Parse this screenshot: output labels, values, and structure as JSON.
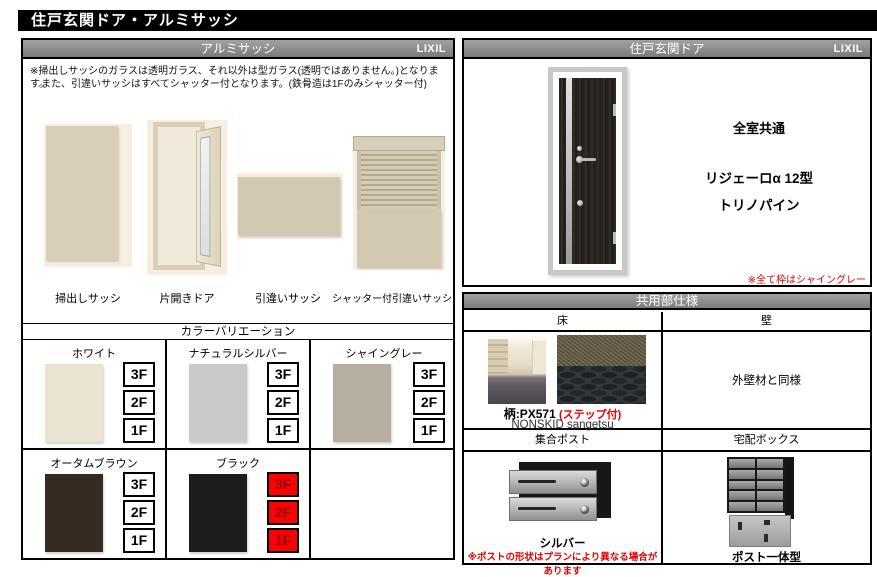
{
  "page": {
    "title": "住戸玄関ドア・アルミサッシ"
  },
  "colors": {
    "header_gray": "#8a8a8a",
    "highlight_red": "#ff0000",
    "note_red": "#e60000"
  },
  "sash": {
    "title": "アルミサッシ",
    "brand": "LIXIL",
    "note1": "※掃出しサッシのガラスは透明ガラス、それ以外は型ガラス(透明ではありません。)となります。",
    "note2": "また、引違いサッシはすべてシャッター付となります。(鉄骨造は1Fのみシャッター付)",
    "products": [
      {
        "label": "掃出しサッシ"
      },
      {
        "label": "片開きドア"
      },
      {
        "label": "引違いサッシ"
      },
      {
        "label": "シャッター付引違いサッシ"
      }
    ],
    "color_title": "カラーバリエーション",
    "floors": [
      "3F",
      "2F",
      "1F"
    ],
    "highlight_color": "#ff0000",
    "colors": [
      {
        "label": "ホワイト",
        "frame": "#e9e3d2"
      },
      {
        "label": "ナチュラルシルバー",
        "frame": "#c9c9c7"
      },
      {
        "label": "シャイングレー",
        "frame": "#b6aea1"
      },
      {
        "label": "オータムブラウン",
        "frame": "#352b23"
      },
      {
        "label": "ブラック",
        "frame": "#1c1c1c"
      }
    ]
  },
  "door": {
    "title": "住戸玄関ドア",
    "brand": "LIXIL",
    "common": "全室共通",
    "model": "リジェーロα 12型",
    "finish": "トリノパイン",
    "note": "※全て枠はシャイングレー"
  },
  "common": {
    "title": "共用部仕様",
    "floor_header": "床",
    "wall_header": "壁",
    "wall_text": "外壁材と同様",
    "pattern": "柄:PX571",
    "pattern_note": "(ステップ付)",
    "maker": "NONSKID sangetsu",
    "mail_header": "集合ポスト",
    "mail_color": "シルバー",
    "mail_note": "※ポストの形状はプランにより異なる場合があります",
    "delivery_header": "宅配ボックス",
    "delivery_label": "ポスト一体型"
  }
}
